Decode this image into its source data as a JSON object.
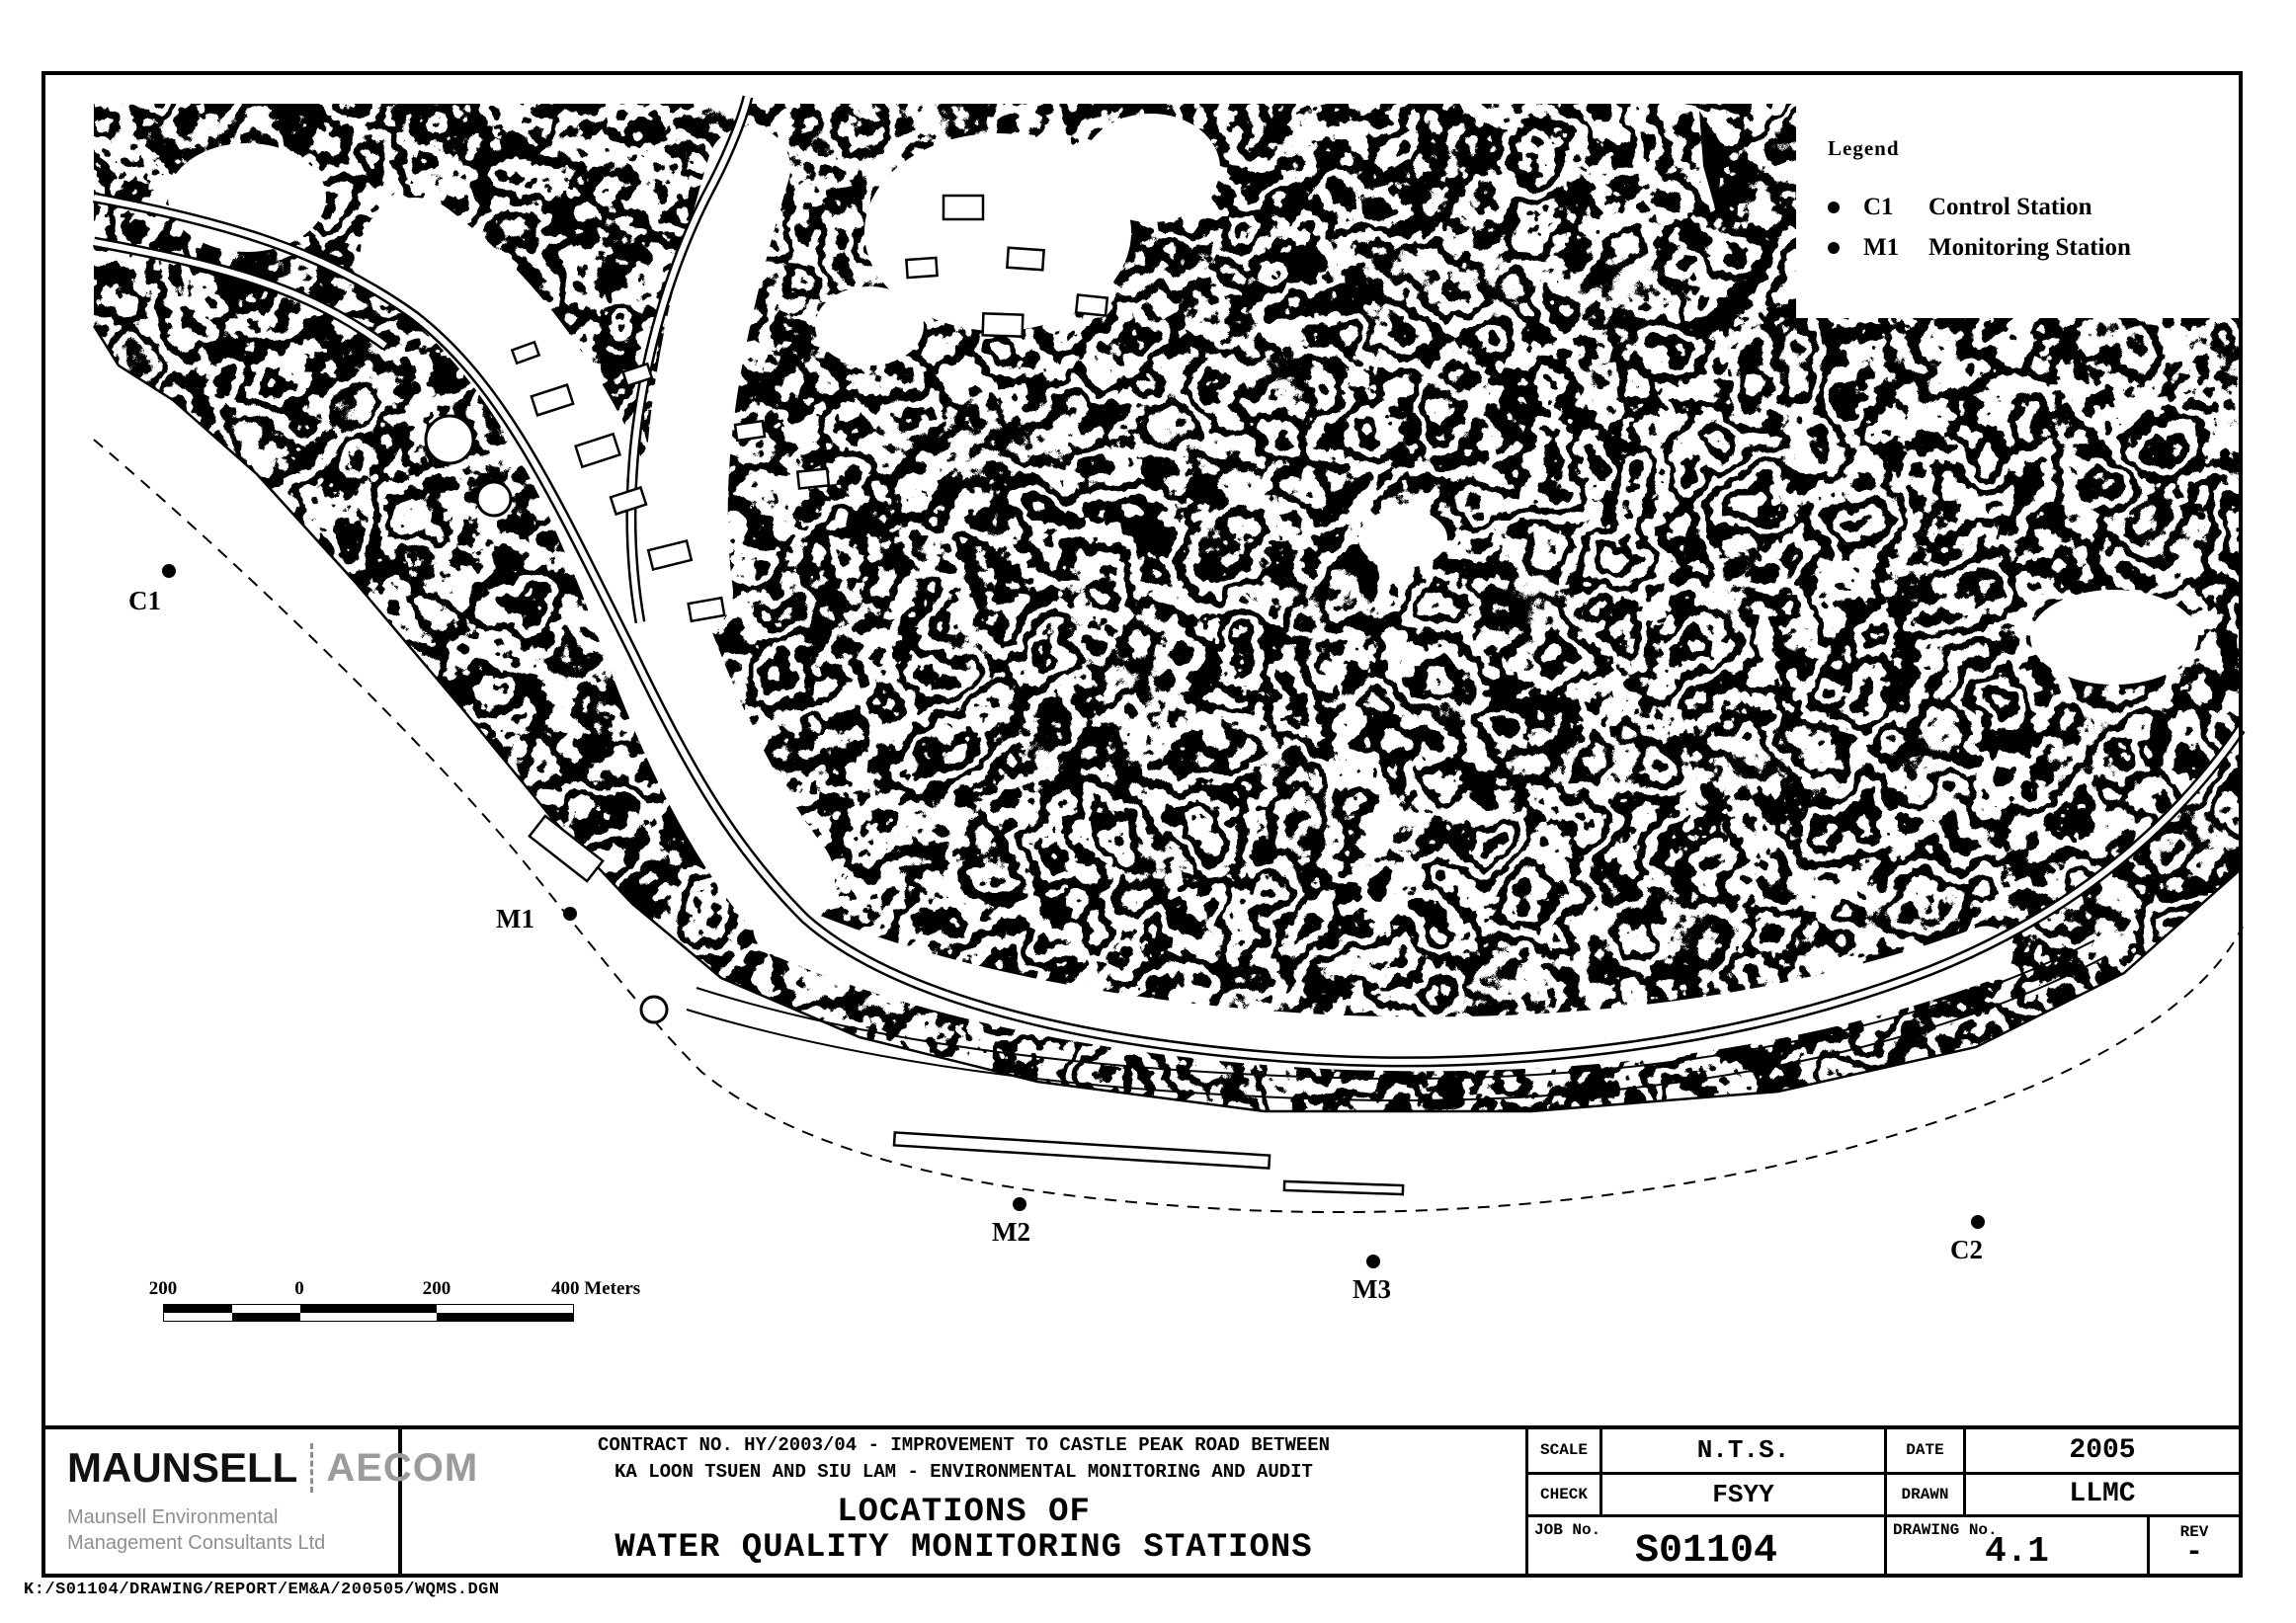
{
  "legend": {
    "title": "Legend",
    "items": [
      {
        "code": "C1",
        "label": "Control Station"
      },
      {
        "code": "M1",
        "label": "Monitoring Station"
      }
    ]
  },
  "stations": [
    {
      "label": "C1",
      "type": "control"
    },
    {
      "label": "M1",
      "type": "monitoring"
    },
    {
      "label": "M2",
      "type": "monitoring"
    },
    {
      "label": "M3",
      "type": "monitoring"
    },
    {
      "label": "C2",
      "type": "control"
    }
  ],
  "scale_bar": {
    "labels": [
      "200",
      "0",
      "200",
      "400 Meters"
    ]
  },
  "logo": {
    "primary": "MAUNSELL",
    "secondary": "AECOM",
    "subline1": "Maunsell Environmental",
    "subline2": "Management Consultants Ltd"
  },
  "title_block": {
    "contract_line1": "CONTRACT NO. HY/2003/04 - IMPROVEMENT TO CASTLE PEAK ROAD BETWEEN",
    "contract_line2": "KA LOON TSUEN AND SIU LAM - ENVIRONMENTAL MONITORING AND AUDIT",
    "title_line1": "LOCATIONS OF",
    "title_line2": "WATER QUALITY MONITORING STATIONS",
    "scale_label": "SCALE",
    "scale_value": "N.T.S.",
    "date_label": "DATE",
    "date_value": "2005",
    "check_label": "CHECK",
    "check_value": "FSYY",
    "drawn_label": "DRAWN",
    "drawn_value": "LLMC",
    "job_label": "JOB No.",
    "job_value": "S01104",
    "drawing_label": "DRAWING No.",
    "drawing_value": "4.1",
    "rev_label": "REV",
    "rev_value": "-"
  },
  "footer_path": "K:/S01104/DRAWING/REPORT/EM&A/200505/WQMS.DGN"
}
